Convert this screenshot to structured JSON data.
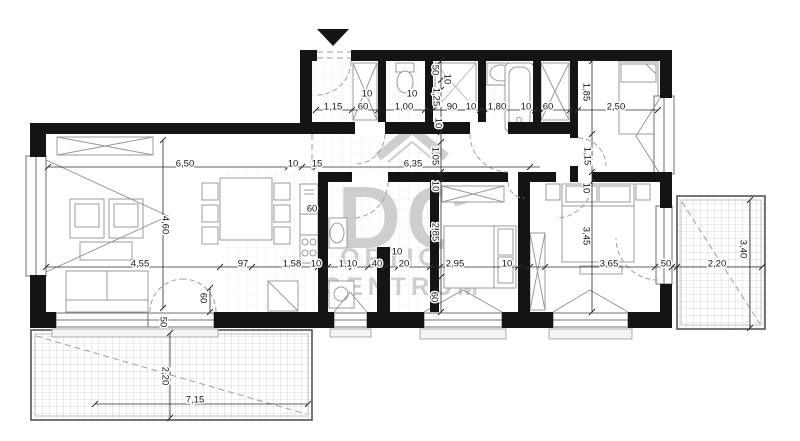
{
  "watermark": {
    "logo_letters": "DC",
    "line1": "OPTION",
    "line2": "CENTRUM"
  },
  "colors": {
    "wall": "#141414",
    "furniture": "#9b9b9b",
    "watermark": "#c3c3c3",
    "dimension_text": "#161616"
  },
  "labels": [
    {
      "t": "1,15",
      "x": 333,
      "y": 106,
      "r": 0
    },
    {
      "t": "60",
      "x": 363,
      "y": 106,
      "r": 0
    },
    {
      "t": "1,00",
      "x": 404,
      "y": 106,
      "r": 0
    },
    {
      "t": "90",
      "x": 452,
      "y": 106,
      "r": 0
    },
    {
      "t": "10",
      "x": 471,
      "y": 106,
      "r": 0
    },
    {
      "t": "1,80",
      "x": 497,
      "y": 106,
      "r": 0
    },
    {
      "t": "10",
      "x": 526,
      "y": 106,
      "r": 0
    },
    {
      "t": "60",
      "x": 548,
      "y": 106,
      "r": 0
    },
    {
      "t": "2,50",
      "x": 616,
      "y": 106,
      "r": 0
    },
    {
      "t": "10",
      "x": 367,
      "y": 93,
      "r": 0
    },
    {
      "t": "10",
      "x": 412,
      "y": 93,
      "r": 0
    },
    {
      "t": "50",
      "x": 436,
      "y": 70,
      "r": 90
    },
    {
      "t": "10",
      "x": 448,
      "y": 79,
      "r": 90
    },
    {
      "t": "1,25",
      "x": 437,
      "y": 97,
      "r": 90
    },
    {
      "t": "10",
      "x": 439,
      "y": 123,
      "r": 90
    },
    {
      "t": "1,05",
      "x": 436,
      "y": 156,
      "r": 90
    },
    {
      "t": "10",
      "x": 436,
      "y": 186,
      "r": 90
    },
    {
      "t": "2,85",
      "x": 436,
      "y": 232,
      "r": 90
    },
    {
      "t": "60",
      "x": 435,
      "y": 297,
      "r": 90
    },
    {
      "t": "1,85",
      "x": 587,
      "y": 92,
      "r": 90
    },
    {
      "t": "1,15",
      "x": 588,
      "y": 156,
      "r": 90
    },
    {
      "t": "10",
      "x": 587,
      "y": 188,
      "r": 90
    },
    {
      "t": "3,45",
      "x": 587,
      "y": 236,
      "r": 90
    },
    {
      "t": "6,50",
      "x": 185,
      "y": 163,
      "r": 0
    },
    {
      "t": "10",
      "x": 293,
      "y": 163,
      "r": 0
    },
    {
      "t": "15",
      "x": 317,
      "y": 163,
      "r": 0
    },
    {
      "t": "6,35",
      "x": 413,
      "y": 163,
      "r": 0
    },
    {
      "t": "4,60",
      "x": 166,
      "y": 225,
      "r": 90
    },
    {
      "t": "4,55",
      "x": 140,
      "y": 263,
      "r": 0
    },
    {
      "t": "97",
      "x": 243,
      "y": 263,
      "r": 0
    },
    {
      "t": "1,58",
      "x": 292,
      "y": 263,
      "r": 0
    },
    {
      "t": "10",
      "x": 316,
      "y": 263,
      "r": 0
    },
    {
      "t": "1,10",
      "x": 348,
      "y": 263,
      "r": 0
    },
    {
      "t": "40",
      "x": 377,
      "y": 263,
      "r": 0
    },
    {
      "t": "20",
      "x": 404,
      "y": 263,
      "r": 0
    },
    {
      "t": "10",
      "x": 397,
      "y": 251,
      "r": 0
    },
    {
      "t": "2,95",
      "x": 455,
      "y": 263,
      "r": 0
    },
    {
      "t": "10",
      "x": 507,
      "y": 263,
      "r": 0
    },
    {
      "t": "3,65",
      "x": 609,
      "y": 263,
      "r": 0
    },
    {
      "t": "50",
      "x": 666,
      "y": 263,
      "r": 0
    },
    {
      "t": "2,20",
      "x": 717,
      "y": 263,
      "r": 0
    },
    {
      "t": "3,40",
      "x": 744,
      "y": 249,
      "r": 90
    },
    {
      "t": "60",
      "x": 312,
      "y": 208,
      "r": 0
    },
    {
      "t": "60",
      "x": 204,
      "y": 298,
      "r": 90
    },
    {
      "t": "50",
      "x": 164,
      "y": 322,
      "r": 90
    },
    {
      "t": "2,20",
      "x": 166,
      "y": 376,
      "r": 90
    },
    {
      "t": "7,15",
      "x": 195,
      "y": 399,
      "r": 0
    }
  ]
}
